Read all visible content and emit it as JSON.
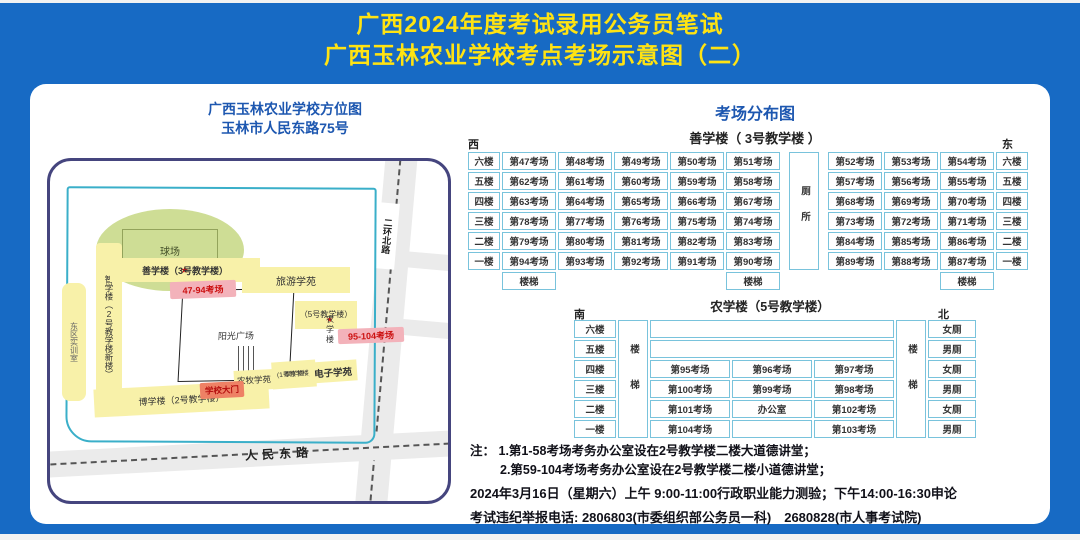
{
  "colors": {
    "background_blue": "#176ac4",
    "title_yellow": "#ffe312",
    "heading_blue": "#1d57b0",
    "table_border_blue": "#79c3dc",
    "building_yellow": "#f8f1a9",
    "exam_pink": "#f3b2ba",
    "gate_orange": "#ee8165",
    "field_green": "#cedd95",
    "road_gray": "#ebebeb",
    "star_red": "#dd1111"
  },
  "title": {
    "line1": "广西2024年度考试录用公务员笔试",
    "line2": "广西玉林农业学校考点考场示意图（二）"
  },
  "map": {
    "title1": "广西玉林农业学校方位图",
    "title2": "玉林市人民东路75号",
    "field_label": "球场",
    "dorm_strip": "东区实训室",
    "bldg2_new": "智学楼（2号教学楼新楼）",
    "star": "★",
    "bldg3_label": "善学楼（3号教学楼）",
    "rooms_47_94": "47-94考场",
    "tourism": "旅游学苑",
    "agri_line1": "农学楼",
    "agri_line2": "（5号教学楼）",
    "rooms_95_104": "95-104考场",
    "plaza": "阳光广场",
    "boxue": "博学楼（2号教学楼）",
    "gate": "学校大门",
    "agri_husbandry": "农牧学苑",
    "bldg1_line1": "厚学楼",
    "bldg1_line2": "(1号教学楼)",
    "electronics": "电子学苑",
    "road_vertical": "二环北路",
    "road_bottom": "人民东路"
  },
  "distribution": {
    "title": "考场分布图",
    "building1": {
      "name": "善学楼（ 3号教学楼 ）",
      "west": "西",
      "east": "东",
      "toilet": "厕所",
      "stairs": "楼梯",
      "floors": [
        "六楼",
        "五楼",
        "四楼",
        "三楼",
        "二楼",
        "一楼"
      ],
      "rows": [
        {
          "left": [
            "第47考场",
            "第48考场",
            "第49考场",
            "第50考场",
            "第51考场"
          ],
          "right": [
            "第52考场",
            "第53考场",
            "第54考场"
          ]
        },
        {
          "left": [
            "第62考场",
            "第61考场",
            "第60考场",
            "第59考场",
            "第58考场"
          ],
          "right": [
            "第57考场",
            "第56考场",
            "第55考场"
          ]
        },
        {
          "left": [
            "第63考场",
            "第64考场",
            "第65考场",
            "第66考场",
            "第67考场"
          ],
          "right": [
            "第68考场",
            "第69考场",
            "第70考场"
          ]
        },
        {
          "left": [
            "第78考场",
            "第77考场",
            "第76考场",
            "第75考场",
            "第74考场"
          ],
          "right": [
            "第73考场",
            "第72考场",
            "第71考场"
          ]
        },
        {
          "left": [
            "第79考场",
            "第80考场",
            "第81考场",
            "第82考场",
            "第83考场"
          ],
          "right": [
            "第84考场",
            "第85考场",
            "第86考场"
          ]
        },
        {
          "left": [
            "第94考场",
            "第93考场",
            "第92考场",
            "第91考场",
            "第90考场"
          ],
          "right": [
            "第89考场",
            "第88考场",
            "第87考场"
          ]
        }
      ]
    },
    "building2": {
      "name": "农学楼（5号教学楼）",
      "south": "南",
      "north": "北",
      "stairs": "楼梯",
      "floors": [
        "六楼",
        "五楼",
        "四楼",
        "三楼",
        "二楼",
        "一楼"
      ],
      "rows": [
        {
          "merged": true,
          "cells": [],
          "toilet": "女厕"
        },
        {
          "merged": true,
          "cells": [],
          "toilet": "男厕"
        },
        {
          "merged": false,
          "cells": [
            "第95考场",
            "第96考场",
            "第97考场"
          ],
          "toilet": "女厕"
        },
        {
          "merged": false,
          "cells": [
            "第100考场",
            "第99考场",
            "第98考场"
          ],
          "toilet": "男厕"
        },
        {
          "merged": false,
          "cells": [
            "第101考场",
            "办公室",
            "第102考场"
          ],
          "toilet": "女厕"
        },
        {
          "merged": false,
          "cells": [
            "第104考场",
            "",
            "第103考场"
          ],
          "toilet": "男厕"
        }
      ]
    }
  },
  "notes": {
    "label": "注：",
    "n1": "1.第1-58考场考务办公室设在2号教学楼二楼大道德讲堂；",
    "n2": "2.第59-104考场考务办公室设在2号教学楼二楼小道德讲堂；",
    "n3": "2024年3月16日（星期六）上午 9:00-11:00行政职业能力测验；下午14:00-16:30申论",
    "n4": "考试违纪举报电话: 2806803(市委组织部公务员一科)　2680828(市人事考试院)"
  }
}
